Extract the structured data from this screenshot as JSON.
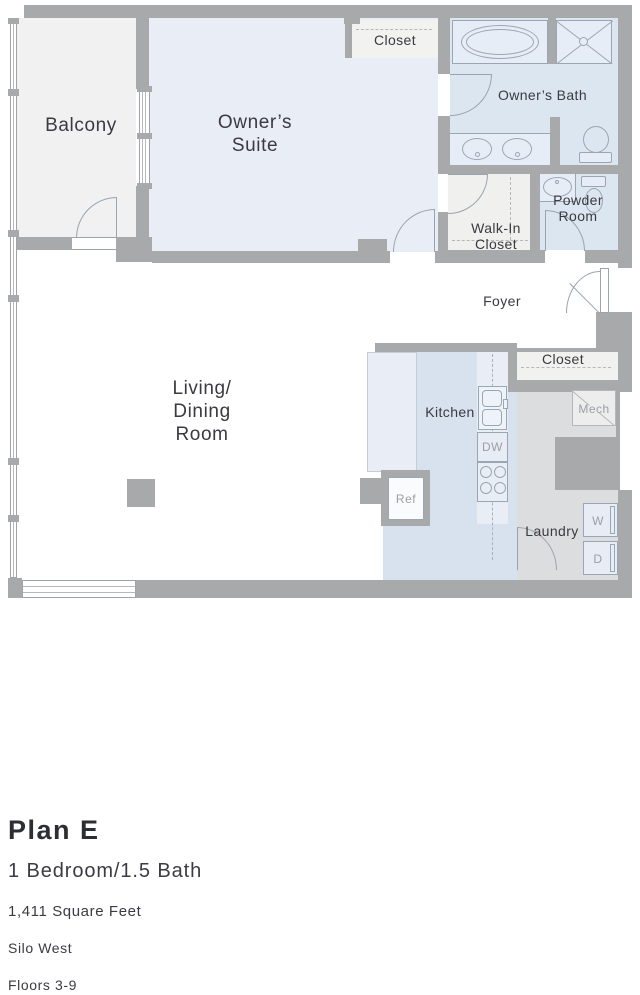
{
  "plan": {
    "title": "Plan E",
    "bed_bath": "1 Bedroom/1.5 Bath",
    "square_feet": "1,411 Square Feet",
    "building": "Silo West",
    "floors": "Floors 3-9"
  },
  "rooms": {
    "balcony": "Balcony",
    "owners_suite_line1": "Owner’s",
    "owners_suite_line2": "Suite",
    "owners_closet": "Closet",
    "owners_bath": "Owner’s Bath",
    "walk_in_line1": "Walk-In",
    "walk_in_line2": "Closet",
    "powder_line1": "Powder",
    "powder_line2": "Room",
    "foyer": "Foyer",
    "coat_closet": "Closet",
    "living_line1": "Living/",
    "living_line2": "Dining",
    "living_line3": "Room",
    "kitchen": "Kitchen",
    "laundry": "Laundry"
  },
  "appliances": {
    "mech": "Mech",
    "dishwasher": "DW",
    "refrigerator": "Ref",
    "washer": "W",
    "dryer": "D"
  },
  "colors": {
    "wall": "#a7a9ab",
    "suite_fill": "#e9edf6",
    "bath_fill": "#dce6f1",
    "kitchen_fill": "#d8e2ef",
    "laundry_fill": "#dcddde",
    "closet_fill": "#f0f0ee",
    "balcony_fill": "#f1f1f2",
    "label_dark": "#3a3a40",
    "label_gray": "#9aa0a6"
  }
}
